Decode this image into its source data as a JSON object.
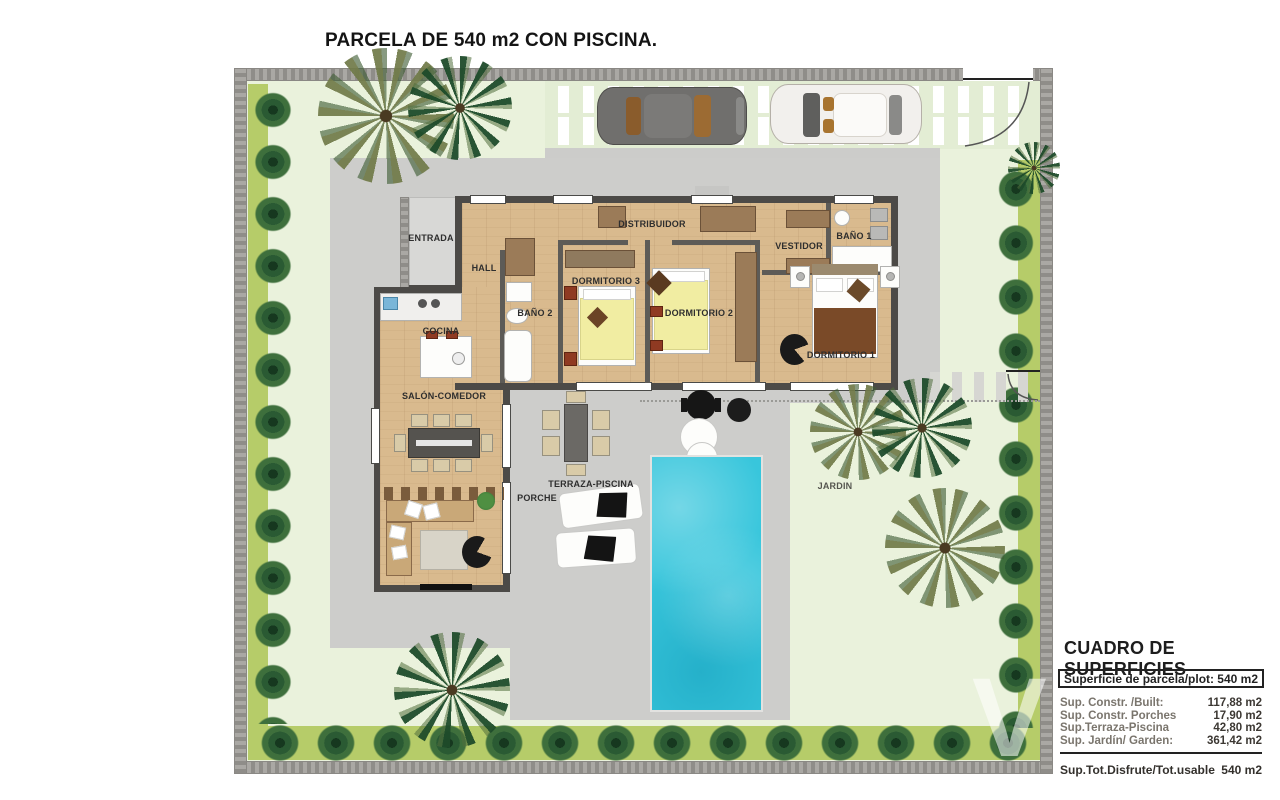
{
  "title": "PARCELA DE 540 m2 CON PISCINA.",
  "watermark": "V",
  "plan": {
    "rooms": [
      {
        "label": "ENTRADA"
      },
      {
        "label": "HALL"
      },
      {
        "label": "DISTRIBUIDOR"
      },
      {
        "label": "BAÑO 2"
      },
      {
        "label": "DORMITORIO 3"
      },
      {
        "label": "DORMITORIO 2"
      },
      {
        "label": "VESTIDOR"
      },
      {
        "label": "BAÑO 1"
      },
      {
        "label": "DORMITORIO 1"
      },
      {
        "label": "COCINA"
      },
      {
        "label": "SALÓN-COMEDOR"
      }
    ],
    "outdoor": [
      "PORCHE",
      "TERRAZA-PISCINA",
      "JARDIN"
    ]
  },
  "areas_table": {
    "title": "CUADRO DE SUPERFICIES",
    "header": {
      "label": "Superficie de parcela/plot:",
      "value": "540 m2"
    },
    "rows": [
      {
        "label": "Sup. Constr. /Built:",
        "value": "117,88 m2"
      },
      {
        "label": "Sup. Constr. Porches",
        "value": "17,90 m2"
      },
      {
        "label": "Sup.Terraza-Piscina",
        "value": "42,80 m2"
      },
      {
        "label": "Sup. Jardín/ Garden:",
        "value": "361,42 m2"
      }
    ],
    "total": {
      "label": "Sup.Tot.Disfrute/Tot.usable",
      "value": "540 m2"
    }
  },
  "colors": {
    "garden": "#eaf2dc",
    "hedge": "#2a5a33",
    "paving": "#cdcdcb",
    "floor": "#d9ba8e",
    "wall": "#4c4a47",
    "pool": "#38c6dc",
    "bed": "#f1eda2",
    "wood": "#9b7b58"
  }
}
